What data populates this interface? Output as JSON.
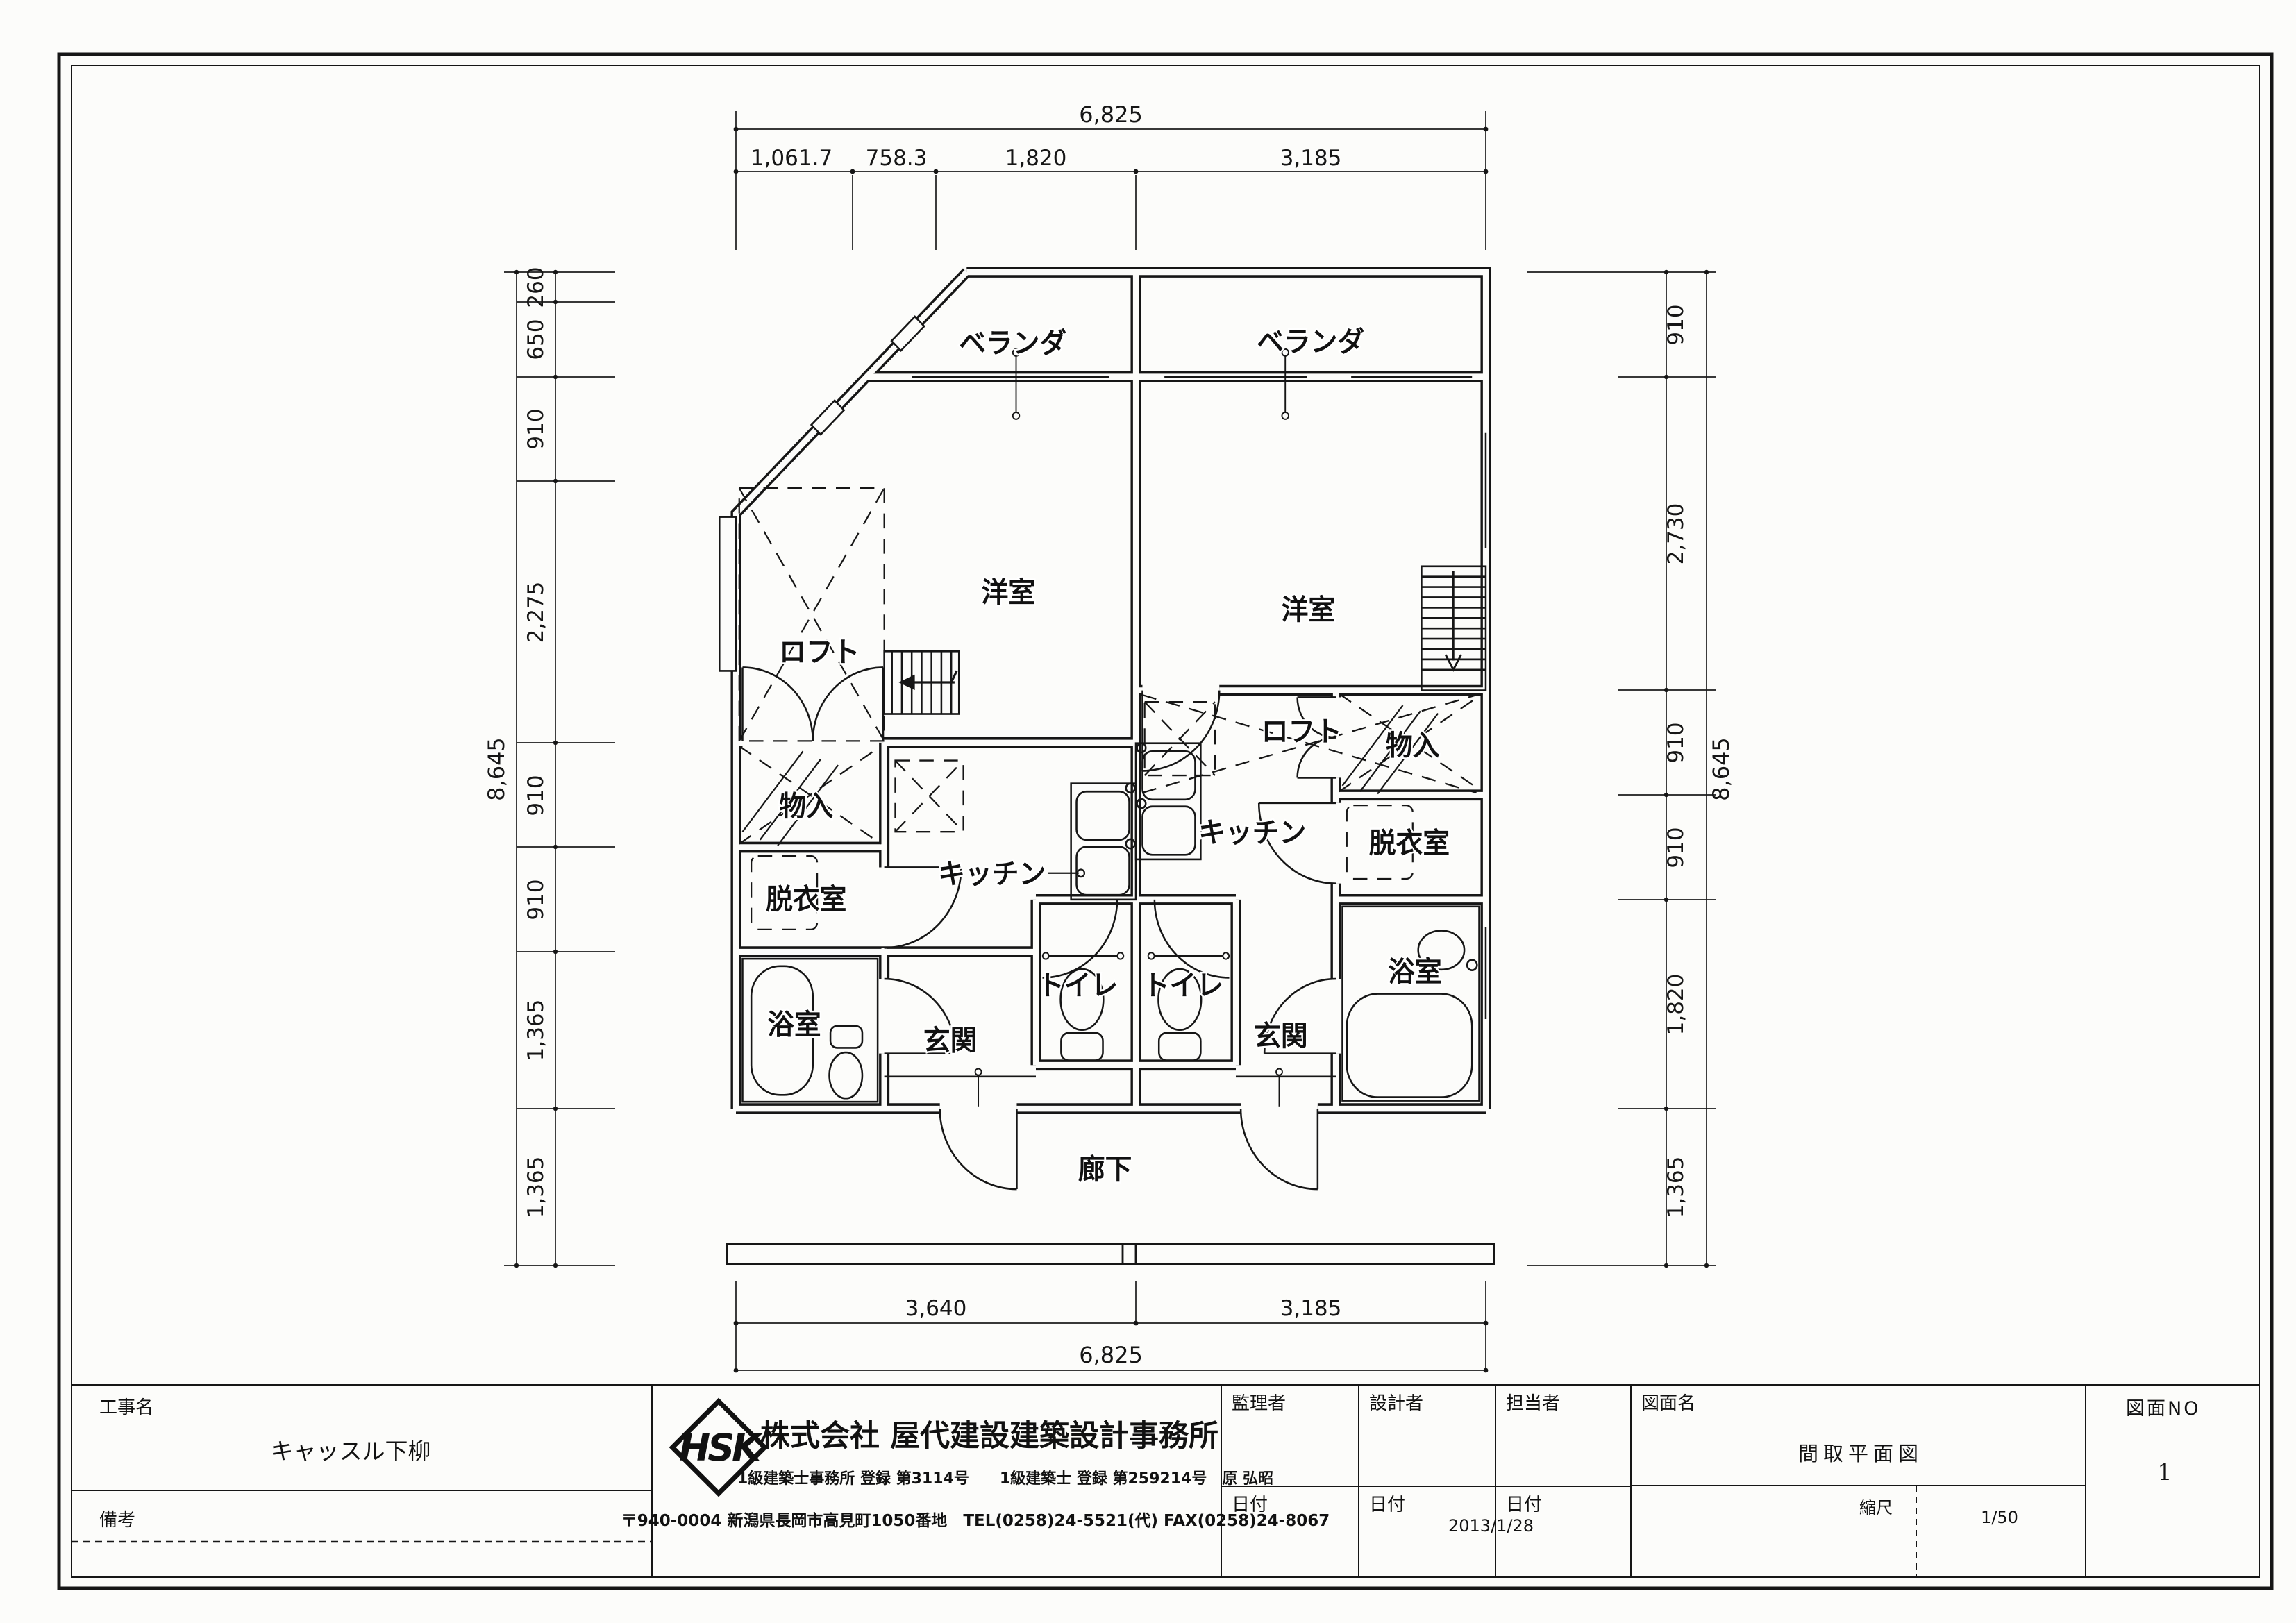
{
  "sheet": {
    "background": "#fcfcfa",
    "line_color": "#161616"
  },
  "title_block": {
    "project_label": "工事名",
    "project_name": "キャッスル下柳",
    "remarks_label": "備考",
    "logo_text": "HSK",
    "company_name": "株式会社 屋代建設建築設計事務所",
    "company_license": "1級建築士事務所 登録 第3114号　　1級建築士 登録 第259214号　原 弘昭",
    "company_address": "〒940-0004 新潟県長岡市高見町1050番地　TEL(0258)24-5521(代) FAX(0258)24-8067",
    "supervisor_label": "監理者",
    "designer_label": "設計者",
    "staff_label": "担当者",
    "date_label_1": "日付",
    "date_label_2": "日付",
    "date_label_3": "日付",
    "design_date": "2013/1/28",
    "drawing_name_label": "図面名",
    "drawing_name": "間取平面図",
    "drawing_no_label": "図面NO",
    "drawing_no": "1",
    "scale_label": "縮尺",
    "scale_value": "1/50"
  },
  "plan": {
    "rooms": {
      "veranda_left": "ベランダ",
      "veranda_right": "ベランダ",
      "yoshitsu_left": "洋室",
      "yoshitsu_right": "洋室",
      "loft_left": "ロフト",
      "loft_right": "ロフト",
      "monoire_left": "物入",
      "monoire_right": "物入",
      "datsuishitsu_left": "脱衣室",
      "datsuishitsu_right": "脱衣室",
      "kitchen_left": "キッチン",
      "kitchen_right": "キッチン",
      "yokushitsu_left": "浴室",
      "yokushitsu_right": "浴室",
      "genkan_left": "玄関",
      "genkan_right": "玄関",
      "toilet_left": "トイレ",
      "toilet_right": "トイレ",
      "rouka": "廊下"
    }
  },
  "dimensions": {
    "top": {
      "overall": "6,825",
      "segments": [
        "1,061.7",
        "758.3",
        "1,820",
        "3,185"
      ]
    },
    "bottom": {
      "overall": "6,825",
      "segments": [
        "3,640",
        "3,185"
      ]
    },
    "left": {
      "overall": "8,645",
      "segments": [
        "260",
        "650",
        "910",
        "2,275",
        "910",
        "910",
        "1,365",
        "1,365"
      ]
    },
    "right": {
      "overall": "8,645",
      "segments": [
        "910",
        "2,730",
        "910",
        "910",
        "1,820",
        "1,365"
      ]
    }
  }
}
